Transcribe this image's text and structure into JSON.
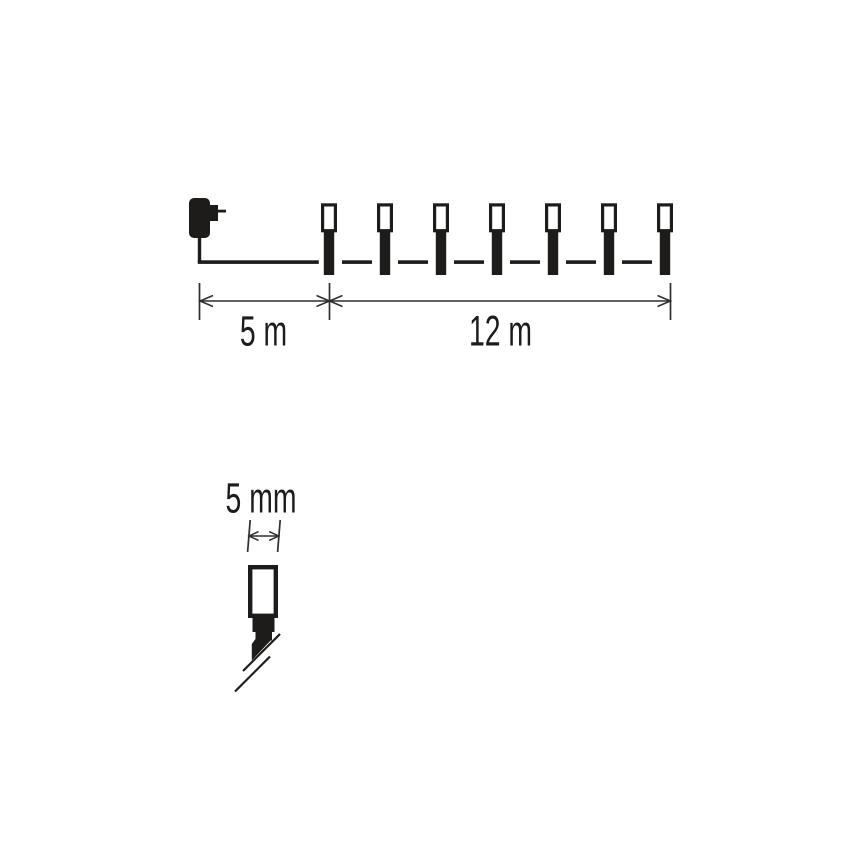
{
  "page": {
    "background": "#ffffff"
  },
  "colors": {
    "ink": "#1d1c1a",
    "dimension_line": "#2e2e2e"
  },
  "diagram": {
    "title": "string-lights-length-diagram",
    "adapter": {
      "icon": "power-adapter-icon"
    },
    "bulbs": {
      "count": 7,
      "icon": "led-bulb-icon"
    },
    "dimensions": {
      "lead_length": "5 m",
      "string_length": "12 m"
    }
  },
  "detail": {
    "icon": "led-bulb-closeup-icon",
    "bulb_width": "5 mm"
  }
}
